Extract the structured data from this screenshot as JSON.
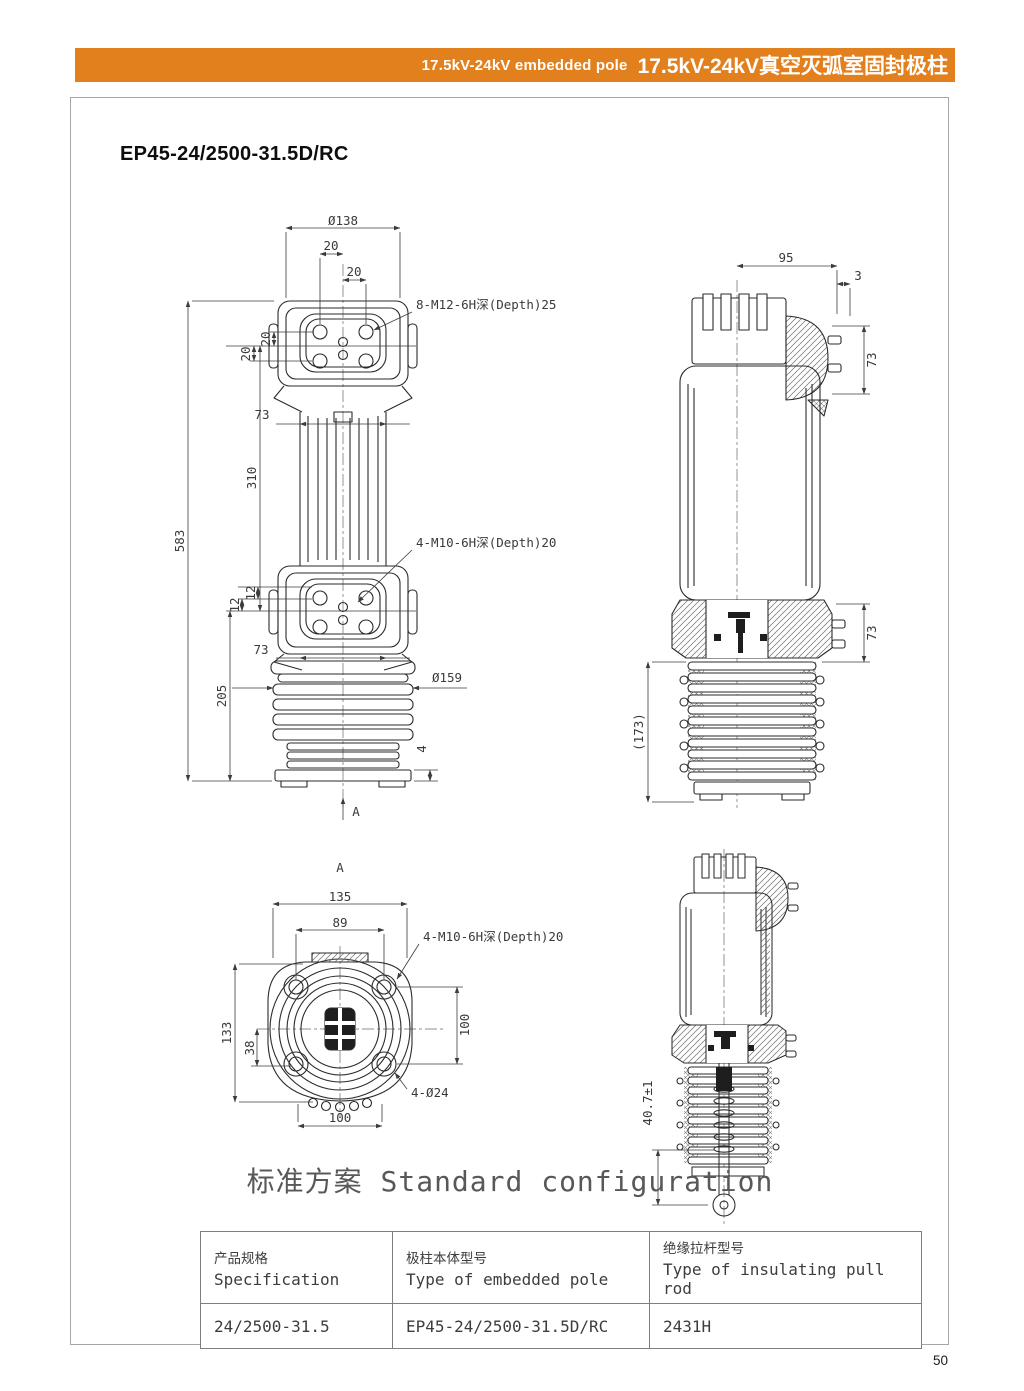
{
  "accent": "#E2801E",
  "header": {
    "title_en": "17.5kV-24kV embedded pole",
    "title_zh": "17.5kV-24kV真空灭弧室固封极柱"
  },
  "model_title": "EP45-24/2500-31.5D/RC",
  "views": {
    "front": {
      "d138": "Ø138",
      "w20a": "20",
      "w20b": "20",
      "bolt_callout": "8-M12-6H深(Depth)25",
      "v20a": "20",
      "v20b": "20",
      "w73a": "73",
      "v310": "310",
      "v583": "583",
      "mid_callout": "4-M10-6H深(Depth)20",
      "v12a": "12",
      "v12b": "12",
      "w73b": "73",
      "d159": "Ø159",
      "v205": "205",
      "v4": "4",
      "view_arrow": "A"
    },
    "side": {
      "w95": "95",
      "w3": "3",
      "v73a": "73",
      "v73b": "73",
      "v173": "(173)"
    },
    "bottom": {
      "view_label": "A",
      "w135": "135",
      "w89": "89",
      "bolt_callout": "4-M10-6H深(Depth)20",
      "v133": "133",
      "v38": "38",
      "v100": "100",
      "hole_callout": "4-Ø24",
      "w100": "100"
    },
    "section": {
      "v40": "40.7±1"
    }
  },
  "config": {
    "heading_zh": "标准方案",
    "heading_en": "Standard configuration"
  },
  "table": {
    "col1_zh": "产品规格",
    "col1_en": "Specification",
    "col2_zh": "极柱本体型号",
    "col2_en": "Type of embedded pole",
    "col3_zh": "绝缘拉杆型号",
    "col3_en": "Type of insulating pull rod",
    "row": {
      "spec": "24/2500-31.5",
      "pole": "EP45-24/2500-31.5D/RC",
      "rod": "2431H"
    }
  },
  "page_number": "50"
}
